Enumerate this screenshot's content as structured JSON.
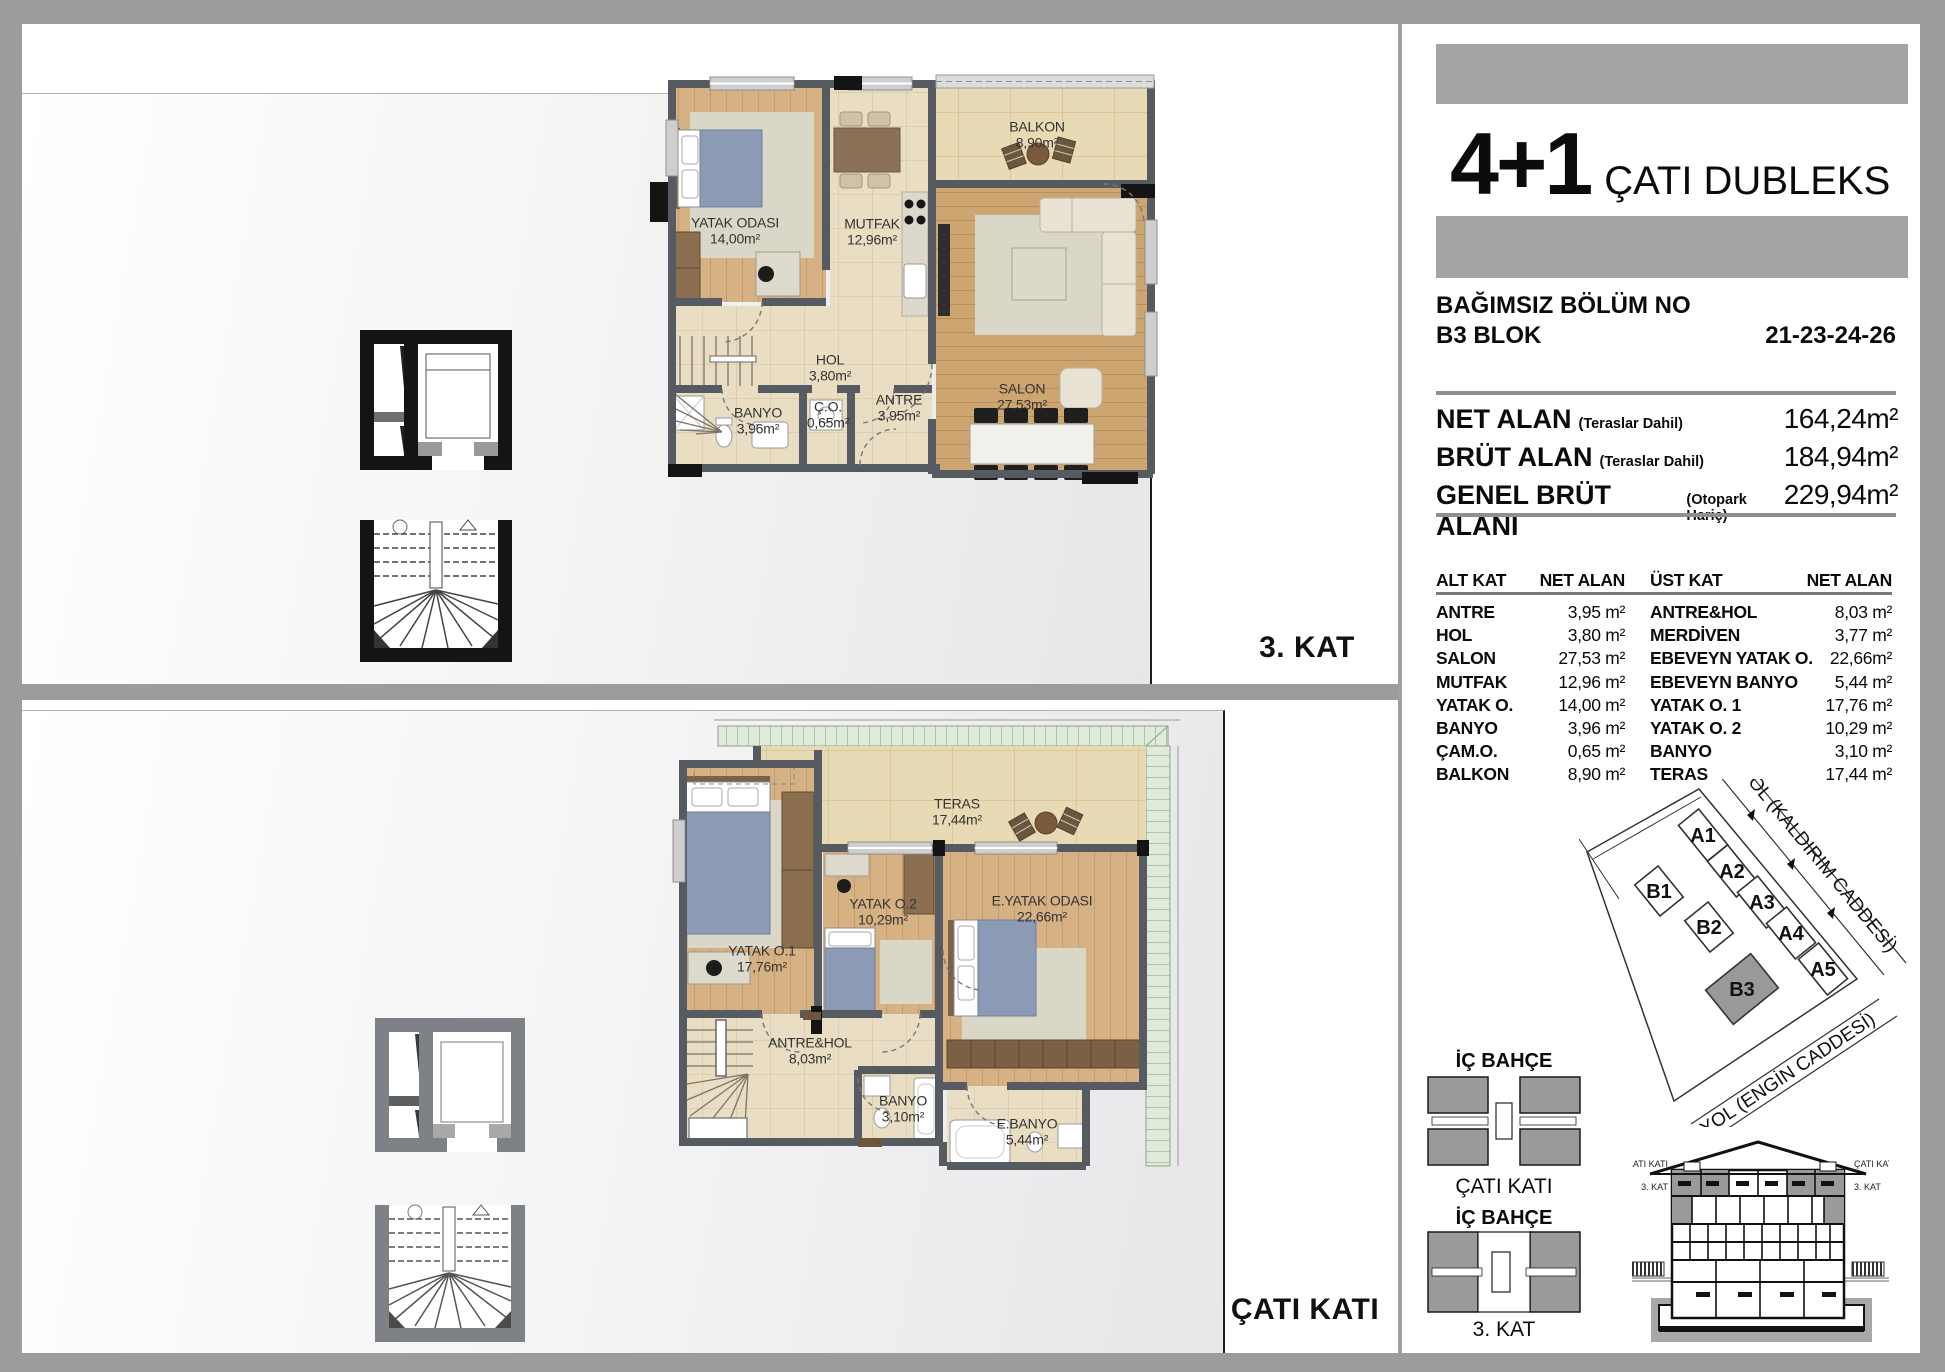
{
  "frame": {
    "floor1_label": "3. KAT",
    "floor2_label": "ÇATI KATI"
  },
  "header": {
    "unit_type": "4+1",
    "unit_name": "ÇATI DUBLEKS",
    "section_title": "BAĞIMSIZ BÖLÜM NO",
    "block": "B3 BLOK",
    "unit_numbers": "21-23-24-26"
  },
  "areas": {
    "rows": [
      {
        "label": "NET ALAN",
        "note": "(Teraslar Dahil)",
        "value": "164,24m²"
      },
      {
        "label": "BRÜT ALAN",
        "note": "(Teraslar Dahil)",
        "value": "184,94m²"
      },
      {
        "label": "GENEL BRÜT ALANI",
        "note": "(Otopark Hariç)",
        "value": "229,94m²"
      }
    ]
  },
  "room_table": {
    "col1_header": "ALT KAT",
    "col1_area_header": "NET ALAN",
    "col2_header": "ÜST KAT",
    "col2_area_header": "NET ALAN",
    "alt_rows": [
      {
        "name": "ANTRE",
        "area": "3,95 m²"
      },
      {
        "name": "HOL",
        "area": "3,80 m²"
      },
      {
        "name": "SALON",
        "area": "27,53 m²"
      },
      {
        "name": "MUTFAK",
        "area": "12,96 m²"
      },
      {
        "name": "YATAK O.",
        "area": "14,00 m²"
      },
      {
        "name": "BANYO",
        "area": "3,96 m²"
      },
      {
        "name": "ÇAM.O.",
        "area": "0,65 m²"
      },
      {
        "name": "BALKON",
        "area": "8,90 m²"
      }
    ],
    "ust_rows": [
      {
        "name": "ANTRE&HOL",
        "area": "8,03 m²"
      },
      {
        "name": "MERDİVEN",
        "area": "3,77 m²"
      },
      {
        "name": "EBEVEYN YATAK O.",
        "area": "22,66m²"
      },
      {
        "name": "EBEVEYN BANYO",
        "area": "5,44 m²"
      },
      {
        "name": "YATAK O. 1",
        "area": "17,76 m²"
      },
      {
        "name": "YATAK O. 2",
        "area": "10,29 m²"
      },
      {
        "name": "BANYO",
        "area": "3,10 m²"
      },
      {
        "name": "TERAS",
        "area": "17,44 m²"
      }
    ]
  },
  "plan1": {
    "rooms": [
      {
        "name": "YATAK ODASI",
        "area": "14,00m²"
      },
      {
        "name": "MUTFAK",
        "area": "12,96m²"
      },
      {
        "name": "BALKON",
        "area": "8,90m²"
      },
      {
        "name": "SALON",
        "area": "27,53m²"
      },
      {
        "name": "HOL",
        "area": "3,80m²"
      },
      {
        "name": "Ç.O.",
        "area": "0,65m²"
      },
      {
        "name": "ANTRE",
        "area": "3,95m²"
      },
      {
        "name": "BANYO",
        "area": "3,96m²"
      }
    ]
  },
  "plan2": {
    "rooms": [
      {
        "name": "TERAS",
        "area": "17,44m²"
      },
      {
        "name": "YATAK O.1",
        "area": "17,76m²"
      },
      {
        "name": "YATAK O.2",
        "area": "10,29m²"
      },
      {
        "name": "E.YATAK ODASI",
        "area": "22,66m²"
      },
      {
        "name": "ANTRE&HOL",
        "area": "8,03m²"
      },
      {
        "name": "BANYO",
        "area": "3,10m²"
      },
      {
        "name": "E.BANYO",
        "area": "5,44m²"
      }
    ]
  },
  "site_plan": {
    "road1": "YOL (KALDIRIM CADDESİ)",
    "road2": "YOL (ENGİN CADDESİ)",
    "blocks": [
      {
        "label": "A1"
      },
      {
        "label": "A2"
      },
      {
        "label": "A3"
      },
      {
        "label": "A4"
      },
      {
        "label": "A5"
      },
      {
        "label": "B1"
      },
      {
        "label": "B2"
      },
      {
        "label": "B3"
      }
    ],
    "highlighted_block": "B3"
  },
  "key_diagrams": {
    "d1_top": "İÇ BAHÇE",
    "d1_bottom": "ÇATI KATI",
    "d2_top": "İÇ BAHÇE",
    "d2_bottom": "3. KAT"
  },
  "elevation": {
    "left_top": "ÇATI KATI",
    "left_bottom": "3. KAT",
    "right_top": "ÇATI KATI",
    "right_bottom": "3. KAT"
  },
  "colors": {
    "frame_gray": "#9c9c9c",
    "bar_gray": "#a4a4a4",
    "wall": "#5a5f65",
    "wood": "#d2aa7c",
    "tile": "#e9dec3",
    "teras_tile": "#e9dab6",
    "roof_green": "#e0ead9",
    "bed_blue": "#8b9ab5",
    "highlight_gray": "#999999"
  }
}
